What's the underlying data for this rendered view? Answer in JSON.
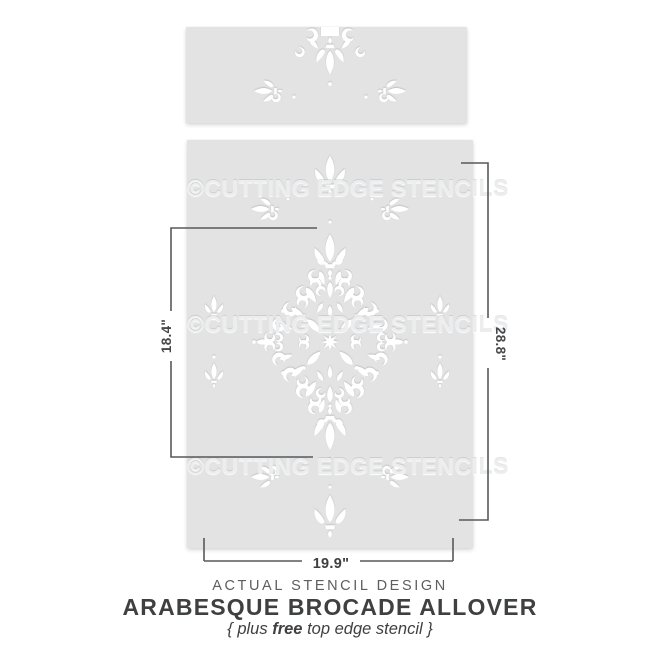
{
  "preview": {
    "watermark": "©CUTTING EDGE STENCILS"
  },
  "measurements": {
    "design_height": "18.4\"",
    "stencil_height": "28.8\"",
    "design_width": "19.9\""
  },
  "footer": {
    "caption": "ACTUAL STENCIL DESIGN",
    "title": "ARABESQUE BROCADE ALLOVER",
    "subtitle_open": "{ plus ",
    "subtitle_bold": "free",
    "subtitle_rest": " top edge stencil }"
  },
  "colors": {
    "sheet": "#e3e3e3",
    "cutout": "#ffffff",
    "dimension_line": "#58595b",
    "title_text": "#3f4042",
    "caption_text": "#5d5e60"
  }
}
